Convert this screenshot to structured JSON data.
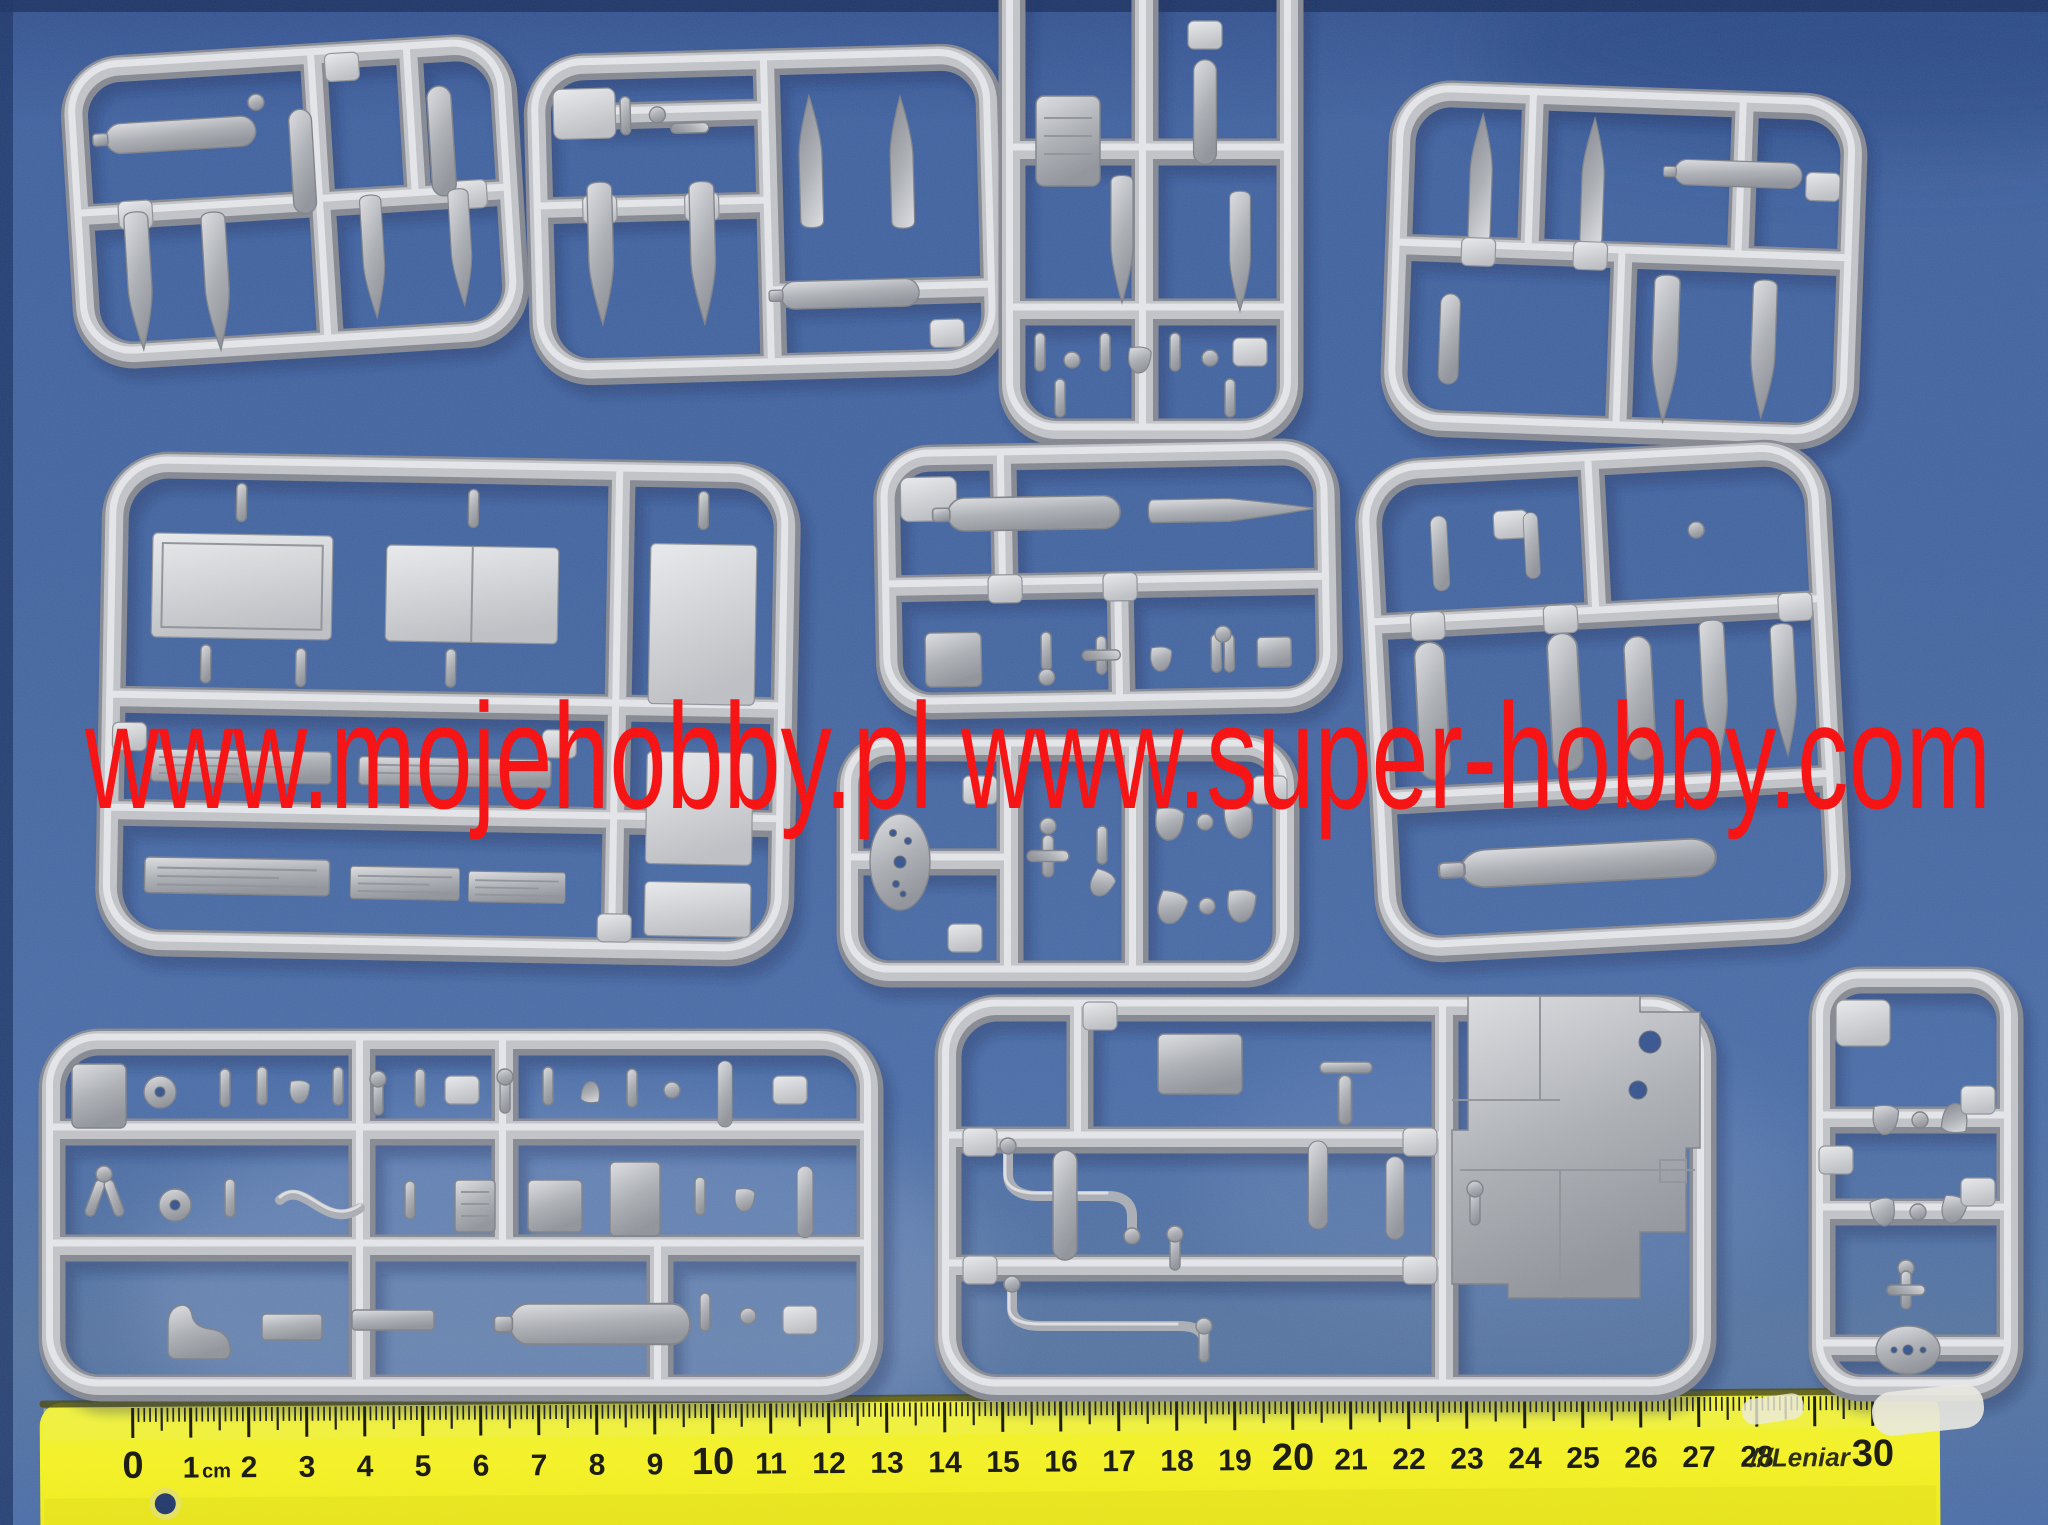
{
  "photo": {
    "subject": "plastic-model-kit-sprues",
    "description": "Eleven light grey injection moulded sprues with bombs, shells, torpedoes, pontoon deck plates and small fittings, photographed on a blue textured background with a yellow ruler at the bottom edge",
    "background_color": "#44659f",
    "plastic_color": "#c0c2c6"
  },
  "watermark": {
    "text": "www.mojehobby.pl www.super-hobby.com",
    "color": "#f60b0b"
  },
  "ruler": {
    "unit_label": "cm",
    "tick_labels": [
      "0",
      "1",
      "2",
      "3",
      "4",
      "5",
      "6",
      "7",
      "8",
      "9",
      "10",
      "11",
      "12",
      "13",
      "14",
      "15",
      "16",
      "17",
      "18",
      "19",
      "20",
      "21",
      "22",
      "23",
      "24",
      "25",
      "26",
      "27",
      "28",
      "",
      "30"
    ],
    "brand_prefix": "///",
    "brand": "Leniar",
    "body_color": "#f0ed1d",
    "tick_color": "#1b1b10"
  },
  "sprues": [
    {
      "name": "sprue-top-left",
      "content": "torpedo and pointed artillery shells"
    },
    {
      "name": "sprue-top-second",
      "content": "bullet shaped shells and torpedo"
    },
    {
      "name": "sprue-top-middle",
      "content": "depth bomb, shell and small fittings (cut off at top edge)"
    },
    {
      "name": "sprue-top-right",
      "content": "shells and bombs"
    },
    {
      "name": "sprue-middle-left-large",
      "content": "pontoon deck plates and grating strips"
    },
    {
      "name": "sprue-middle-center",
      "content": "torpedo, shell and small fittings"
    },
    {
      "name": "sprue-middle-right",
      "content": "cylinders and shells"
    },
    {
      "name": "sprue-center-small-parts",
      "content": "drum, seats and tiny fittings"
    },
    {
      "name": "sprue-bottom-left",
      "content": "dense rows of small deck fittings"
    },
    {
      "name": "sprue-bottom-center",
      "content": "piping runs, boxes and large hull plate"
    },
    {
      "name": "sprue-bottom-right-small",
      "content": "seats and small pod"
    }
  ]
}
